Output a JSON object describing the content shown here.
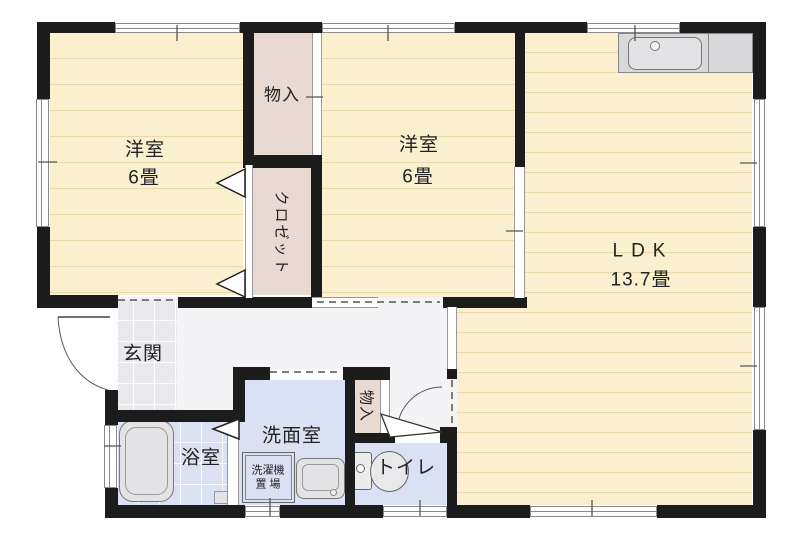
{
  "plan": {
    "rooms": {
      "western1": {
        "label": "洋室",
        "size": "6畳"
      },
      "western2": {
        "label": "洋室",
        "size": "6畳"
      },
      "ldk": {
        "label": "LDK",
        "size": "13.7畳"
      },
      "storage_top": {
        "label": "物入"
      },
      "closet": {
        "label": "クロゼット"
      },
      "entrance": {
        "label": "玄関"
      },
      "bathroom": {
        "label": "浴室"
      },
      "washroom": {
        "label": "洗面室"
      },
      "toilet": {
        "label": "トイレ"
      },
      "storage_hall": {
        "label": "物入"
      },
      "laundry": {
        "line1": "洗濯機",
        "line2": "置 場"
      }
    },
    "colors": {
      "wall": "#1c1c1c",
      "room_cream": "#faf0d0",
      "room_line": "#ead9ab",
      "storage_pink": "#e8d9d2",
      "wet_blue": "#d9e1f3",
      "hall_gray": "#f4f4f6",
      "tile_gray": "#e9e9ed",
      "fixture_gray": "#e3e3e5",
      "counter_gray": "#d9d9db",
      "text": "#222222"
    }
  }
}
